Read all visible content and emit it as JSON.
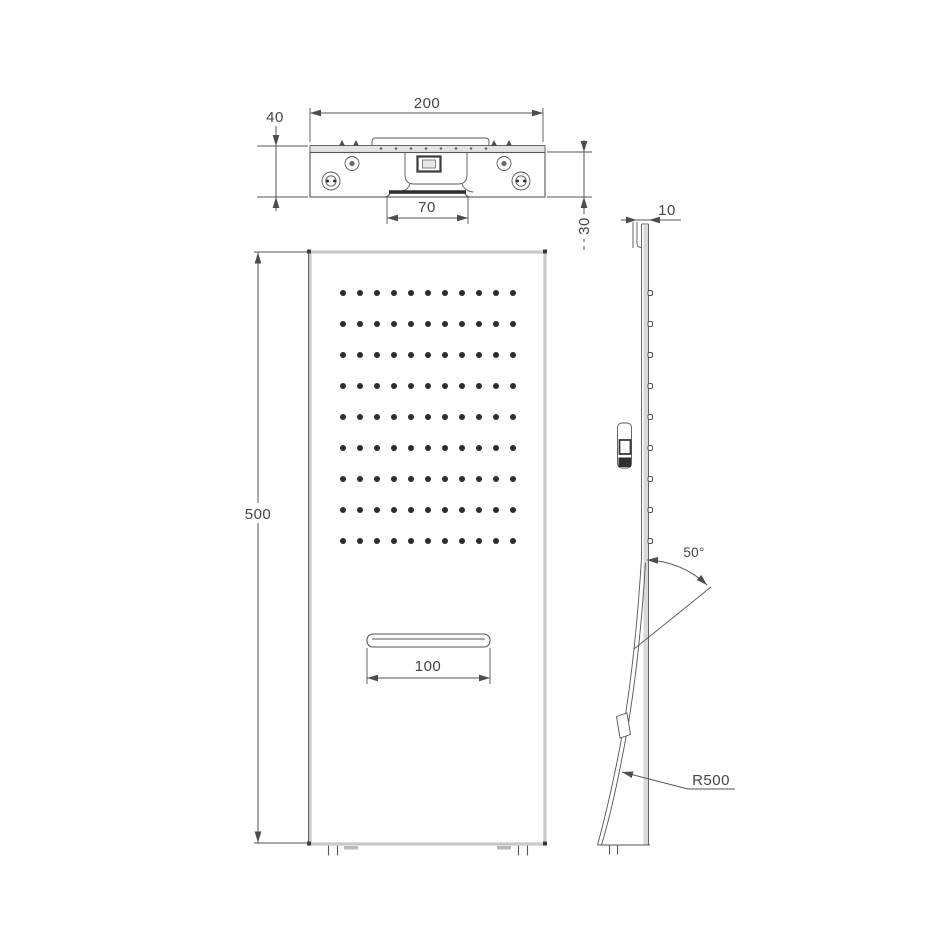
{
  "drawing": {
    "type": "technical-drawing",
    "subject": "shower-panel-orthographic-views",
    "views": {
      "top": "top-view",
      "front": "front-view",
      "side": "side-view"
    },
    "dimensions": {
      "top_width": "200",
      "top_depth": "40",
      "outlet_width": "70",
      "body_depth": "30",
      "panel_height": "500",
      "slot_width": "100",
      "panel_thickness": "10",
      "spray_angle": "50°",
      "bend_radius": "R500"
    },
    "top_view": {
      "strip_dots": {
        "count": 8,
        "origin_x": 381,
        "y": 148.5,
        "spacing": 15,
        "radius": 1.3
      }
    },
    "front_view": {
      "spray_grid": {
        "columns": 11,
        "rows": 9,
        "origin_x": 343,
        "origin_y": 293,
        "col_spacing": 17,
        "row_spacing": 31,
        "dot_radius": 3
      }
    },
    "side_view": {
      "wall_studs": {
        "count": 9,
        "x": 648,
        "origin_y": 293,
        "spacing": 31,
        "width": 4.5,
        "height": 5
      }
    },
    "colors": {
      "line": "#555555",
      "light_edge": "#c9c9c9",
      "dot": "#2d2d2d",
      "text": "#454545",
      "dark_fill": "#2f2f2f",
      "gray_fill": "#d9d9d9",
      "background": "#ffffff"
    }
  }
}
